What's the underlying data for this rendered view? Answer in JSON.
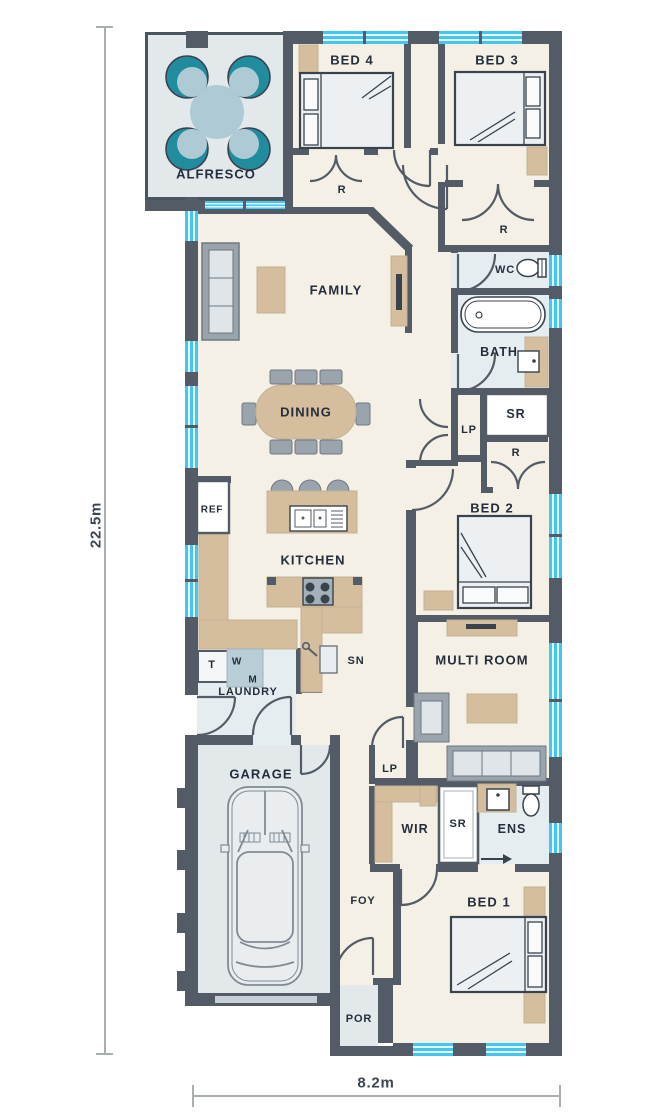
{
  "dimensions": {
    "height_label": "22.5m",
    "width_label": "8.2m"
  },
  "rooms": {
    "alfresco": "ALFRESCO",
    "bed4": "BED 4",
    "bed3": "BED 3",
    "bed2": "BED 2",
    "bed1": "BED 1",
    "family": "FAMILY",
    "dining": "DINING",
    "kitchen": "KITCHEN",
    "laundry": "LAUNDRY",
    "garage": "GARAGE",
    "multi_room": "MULTI ROOM",
    "wir": "WIR",
    "ens": "ENS",
    "bath": "BATH",
    "wc": "WC",
    "foyer": "FOY",
    "porch": "POR",
    "study_nook": "SN"
  },
  "fixtures": {
    "fridge": "REF",
    "laundry_tub": "T",
    "washer": "W",
    "dryer": "M",
    "store_hall": "SR",
    "shower_ens": "SR",
    "linen_hall": "LP",
    "linen_foyer": "LP",
    "robe_bed4": "R",
    "robe_bed3": "R",
    "robe_bed2": "R"
  },
  "colors": {
    "wall": "#525B66",
    "floor": "#F5F0E5",
    "wet_floor": "#E6EDF0",
    "outdoor_floor": "#E3E8EB",
    "window": "#45C6F1",
    "timber": "#D4BE9E",
    "furniture_gray": "#9AA4AC",
    "chair_teal": "#208C9E",
    "text": "#242E3C"
  }
}
